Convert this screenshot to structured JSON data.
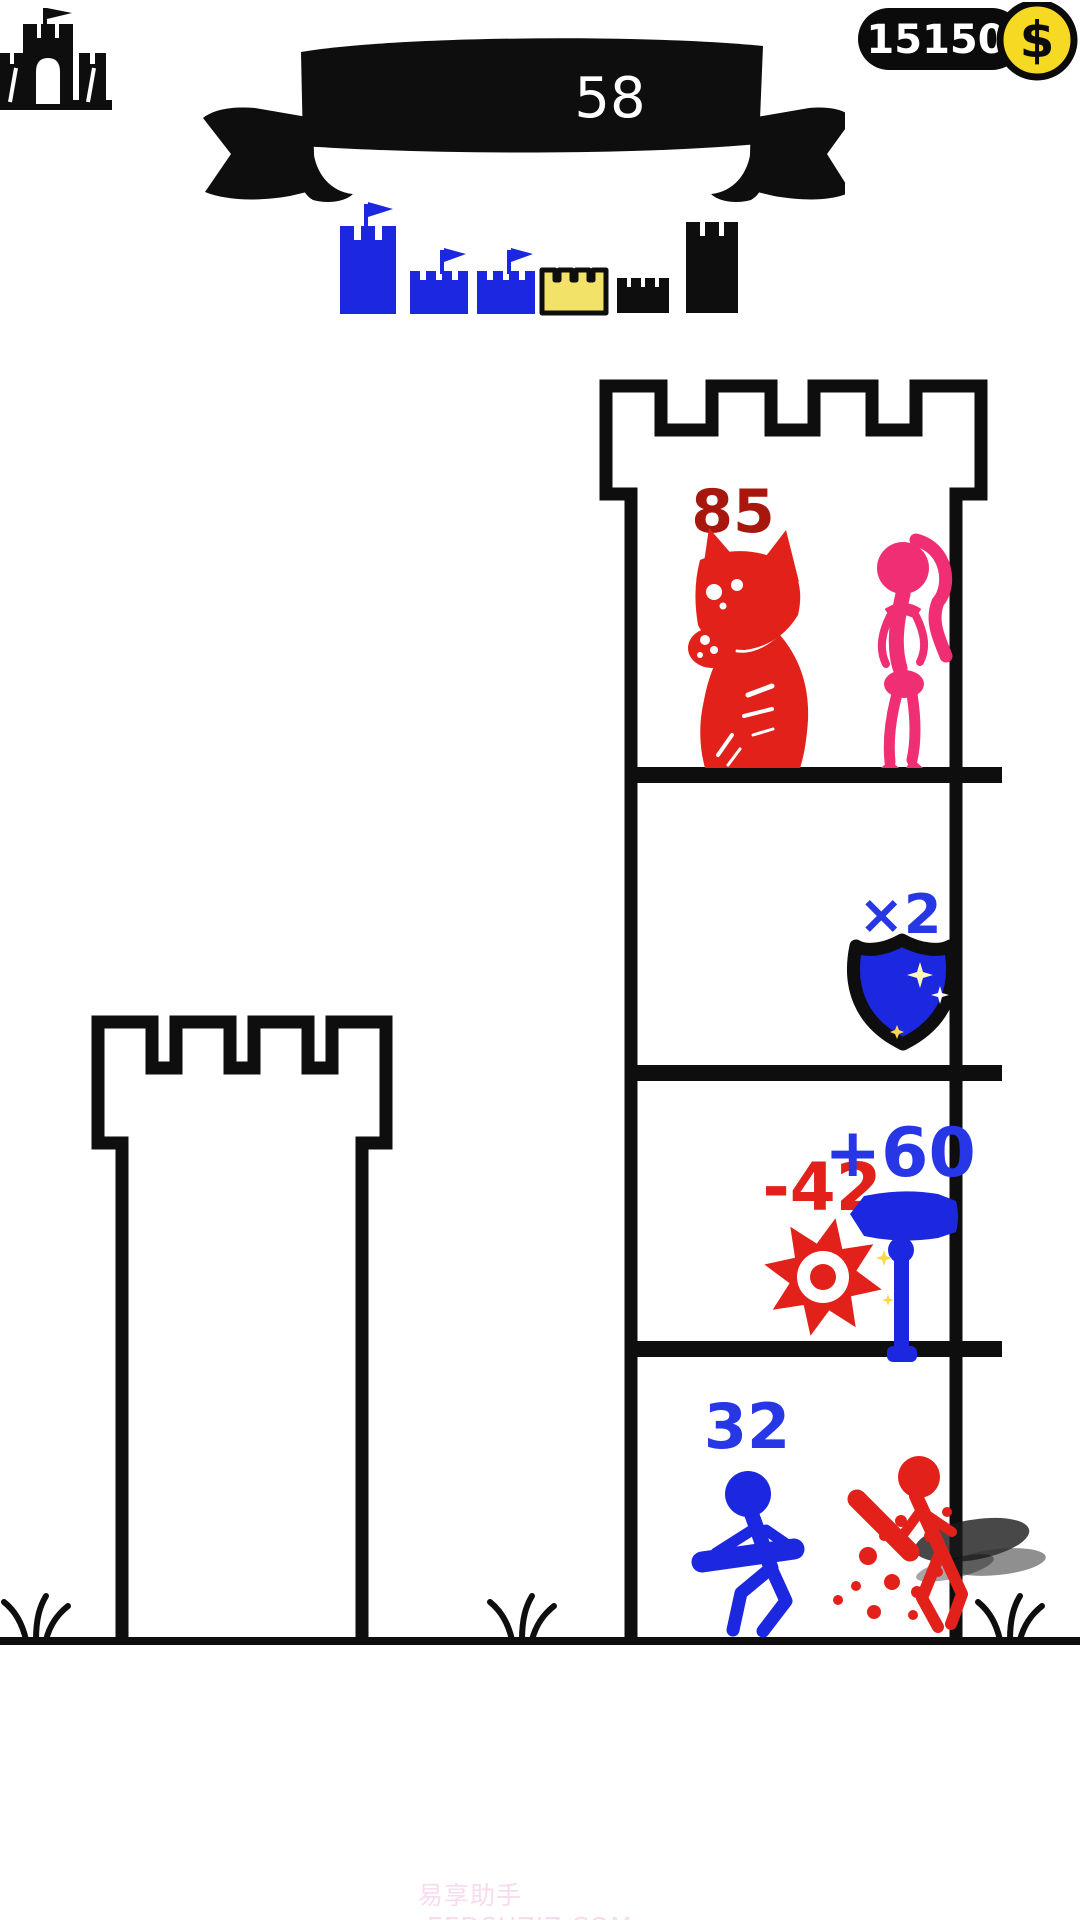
{
  "header": {
    "level": "58",
    "coins": "15150",
    "coin_symbol": "$"
  },
  "progress_row": {
    "castles": [
      {
        "name": "large-blue-castle",
        "color": "#1c27e0",
        "flag": true
      },
      {
        "name": "small-blue-castle-1",
        "color": "#1c27e0",
        "flag": true
      },
      {
        "name": "small-blue-castle-2",
        "color": "#1c27e0",
        "flag": true
      },
      {
        "name": "current-level-yellow-castle",
        "color": "#f2e268",
        "flag": false
      },
      {
        "name": "small-black-castle",
        "color": "#0e0e0e",
        "flag": false
      },
      {
        "name": "tall-black-castle",
        "color": "#0e0e0e",
        "flag": false
      }
    ]
  },
  "tower": {
    "floors": [
      {
        "label": "85",
        "label_color": "#a8170e",
        "contents": [
          "red-monster",
          "pink-woman"
        ]
      },
      {
        "label": "×2",
        "label_color": "#2737e6",
        "contents": [
          "blue-shield"
        ]
      },
      {
        "label_red": "-42",
        "label_blue": "+60",
        "contents": [
          "red-saw-blade",
          "blue-hammer"
        ]
      },
      {
        "label": "32",
        "label_color": "#2737e6",
        "contents": [
          "blue-fighter",
          "red-fighter-defeated"
        ]
      }
    ]
  },
  "watermark": "易享助手·EEDSHZJZ.COM",
  "colors": {
    "blue": "#1c27e0",
    "blue_text": "#2737e6",
    "red": "#e2211a",
    "dark_red": "#a8170e",
    "pink": "#f02e74",
    "coin_yellow": "#f5d923",
    "castle_yellow": "#f2e268",
    "ink": "#0e0e0e",
    "watermark_pink": "#f6dcee"
  }
}
